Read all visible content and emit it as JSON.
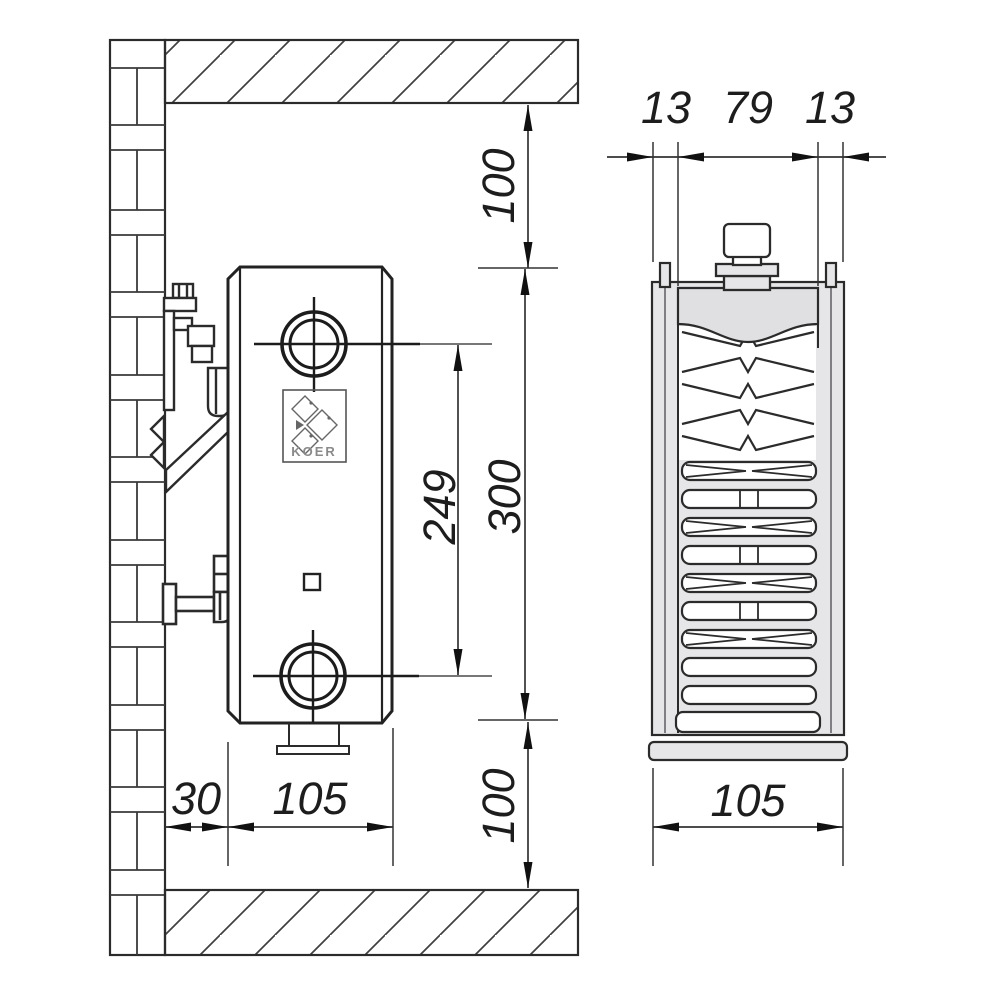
{
  "palette": {
    "line_color": "#2b2b2b",
    "thin_line_color": "#4a4a4a",
    "metal_fill": "#e6e6e8",
    "background": "#ffffff",
    "text_color": "#1d1d1d"
  },
  "side_view": {
    "top_clearance": "100",
    "height": "300",
    "pipe_spacing": "249",
    "bottom_clearance": "100",
    "wall_offset": "30",
    "depth": "105",
    "logo_text": "KOER"
  },
  "section_view": {
    "front_panel": "13",
    "core_width": "79",
    "back_panel": "13",
    "total_depth": "105"
  }
}
